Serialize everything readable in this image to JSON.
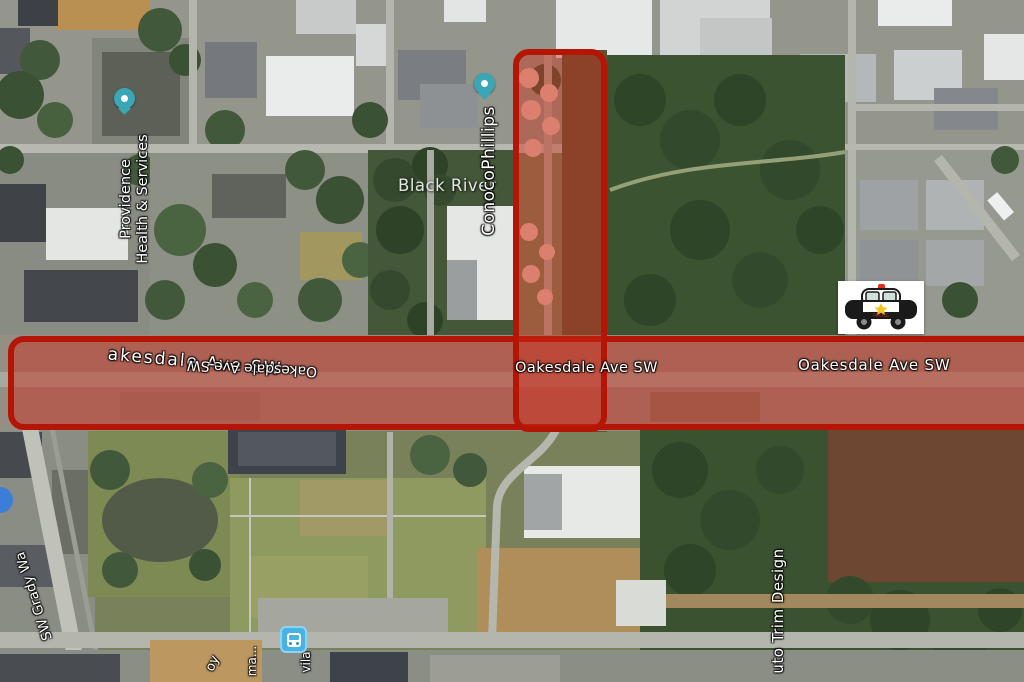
{
  "map": {
    "view_type": "satellite",
    "labels": {
      "providence_line1": "Providence",
      "providence_line2": "Health & Services",
      "black_river": "Black River",
      "conocophillips": "ConocoPhillips",
      "oakesdale_tilted": "akesdale Ave SW",
      "oakesdale_flipped": "Oakesdale Ave SW",
      "oakesdale_center": "Oakesdale Ave SW",
      "oakesdale_right": "Oakesdale Ave SW",
      "sw_grady_way": "SW Grady Wa",
      "auto_trim_design": "uto Trim Design",
      "partial_bottom_1": "oy",
      "partial_bottom_2": "ma...",
      "partial_bottom_3": "vila"
    },
    "markers": {
      "police_car_text": "POLICE"
    },
    "colors": {
      "closure_border": "#b51505",
      "closure_fill": "rgba(204,43,24,0.45)",
      "poi_pin": "#3ba6b5",
      "transit_icon": "#47b2e4",
      "partial_pin": "#3b7dd8"
    }
  }
}
